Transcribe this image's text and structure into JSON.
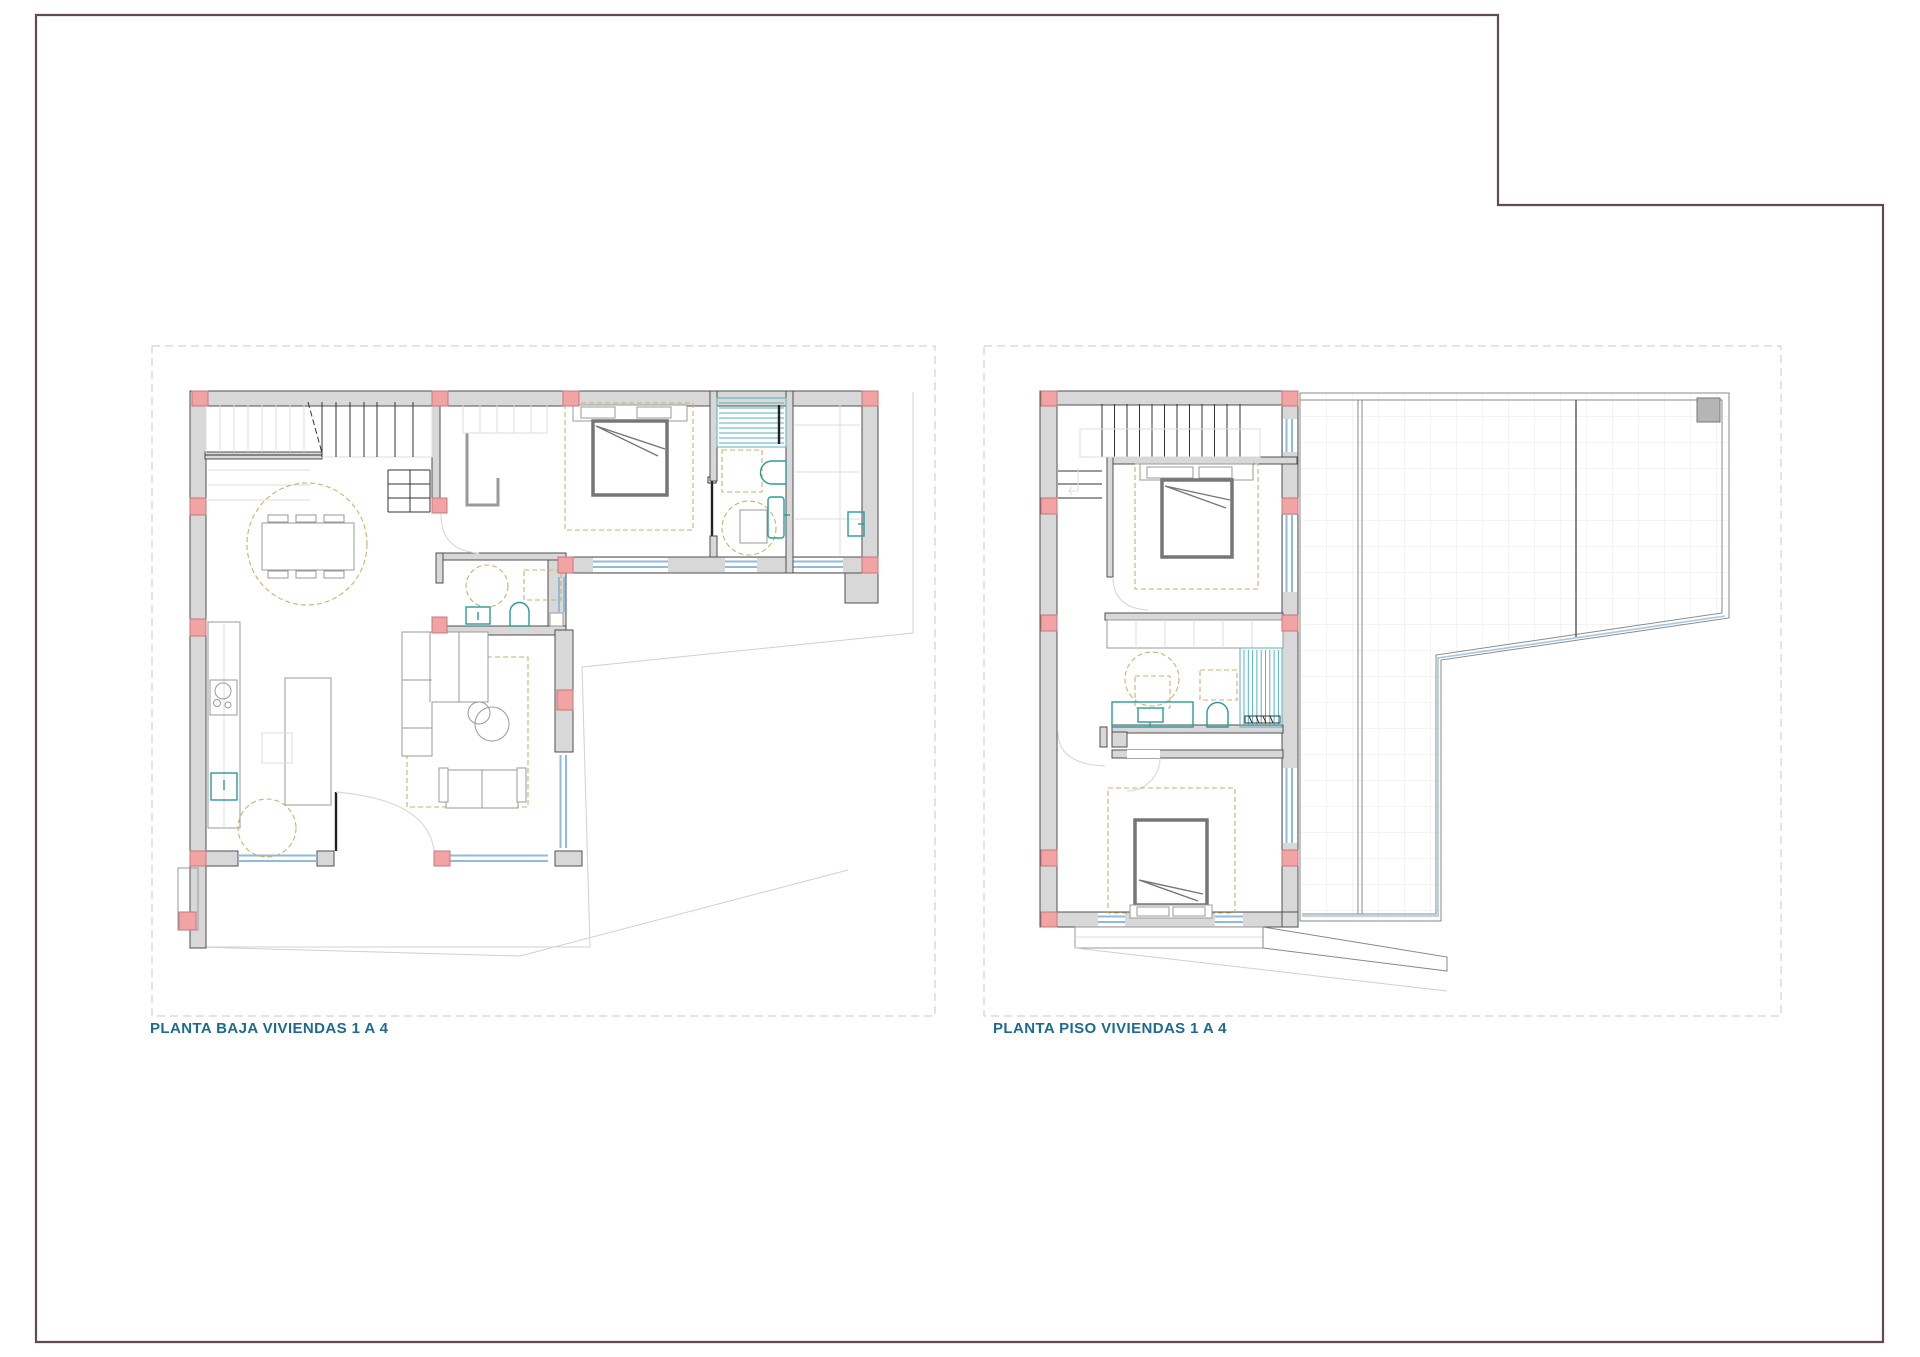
{
  "plans": [
    {
      "id": "planta-baja",
      "label": "PLANTA BAJA VIVIENDAS 1 A 4"
    },
    {
      "id": "planta-piso",
      "label": "PLANTA PISO VIVIENDAS 1 A 4"
    }
  ],
  "colors": {
    "page_border": "#614a52",
    "wall_fill": "#d8d8d8",
    "wall_outline": "#4f4f4f",
    "column_fill": "#f2a3a3",
    "column_border": "#c4797c",
    "window_blue": "#8fbbdc",
    "fixture_teal": "#2a9b9d",
    "furniture_dash_tan": "#cdb06a",
    "dark_furniture": "#767676",
    "label_text": "#1d6b8f",
    "tile_grid": "#e9e9e9",
    "sheet_frame_dash": "#c9c9c9"
  }
}
